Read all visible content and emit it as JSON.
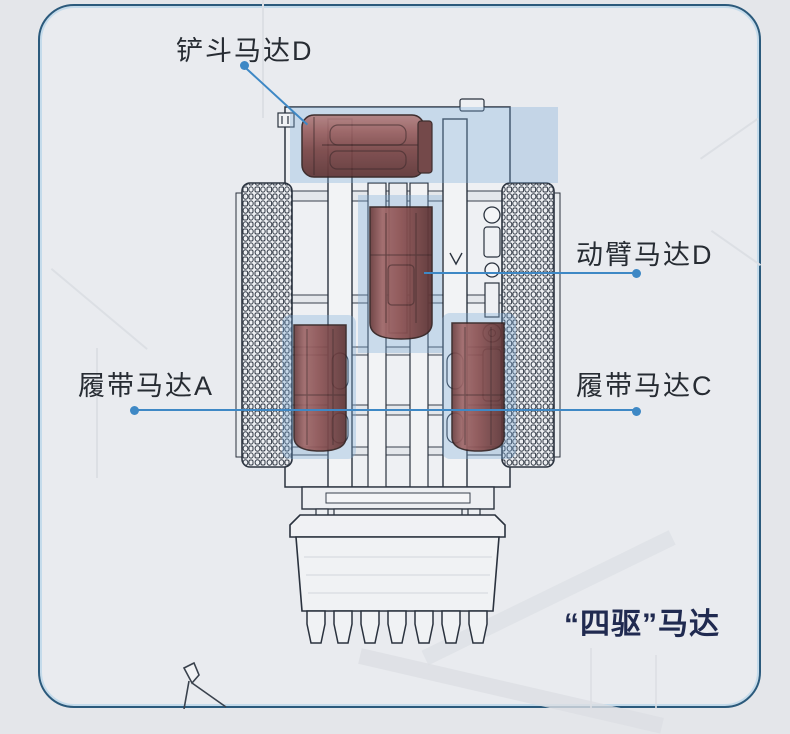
{
  "figure": {
    "diagram": "excavator-top-view-blueprint",
    "callouts": [
      {
        "id": "bucket-motor",
        "label": "铲斗马达D"
      },
      {
        "id": "boom-motor",
        "label": "动臂马达D"
      },
      {
        "id": "track-motor-a",
        "label": "履带马达A"
      },
      {
        "id": "track-motor-c",
        "label": "履带马达C"
      }
    ],
    "caption": "“四驱”马达"
  },
  "colors": {
    "leader_line": "#3e88c5",
    "label_text": "#272c33",
    "caption_text": "#202a50",
    "card_border": "#2b5a7c",
    "motor_highlight": "#8a4e4e",
    "blueprint_tint": "#9cc0e0"
  }
}
